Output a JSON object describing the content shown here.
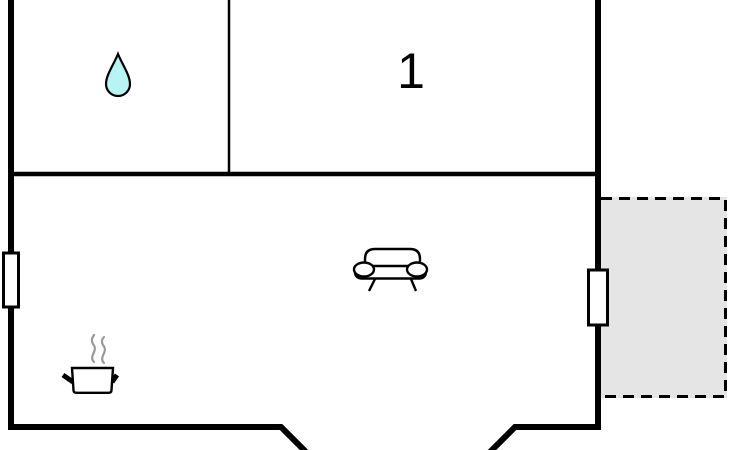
{
  "plan": {
    "type": "floor-plan",
    "rooms": {
      "room1": {
        "label": "1"
      },
      "bathroom": {
        "icon": "water-drop-icon"
      },
      "living_area": {
        "icons": [
          "sofa-icon",
          "cooking-pot-icon"
        ]
      },
      "terrace": {
        "border_style": "dashed"
      }
    },
    "icons": {
      "water_drop": "water-drop-icon",
      "sofa": "sofa-icon",
      "cooking_pot": "cooking-pot-icon"
    },
    "colors": {
      "wall": "#000000",
      "window_fill": "#ffffff",
      "terrace_fill": "#e5e5e5",
      "drop_fill": "#b8f4f4",
      "steam": "#999999"
    }
  }
}
